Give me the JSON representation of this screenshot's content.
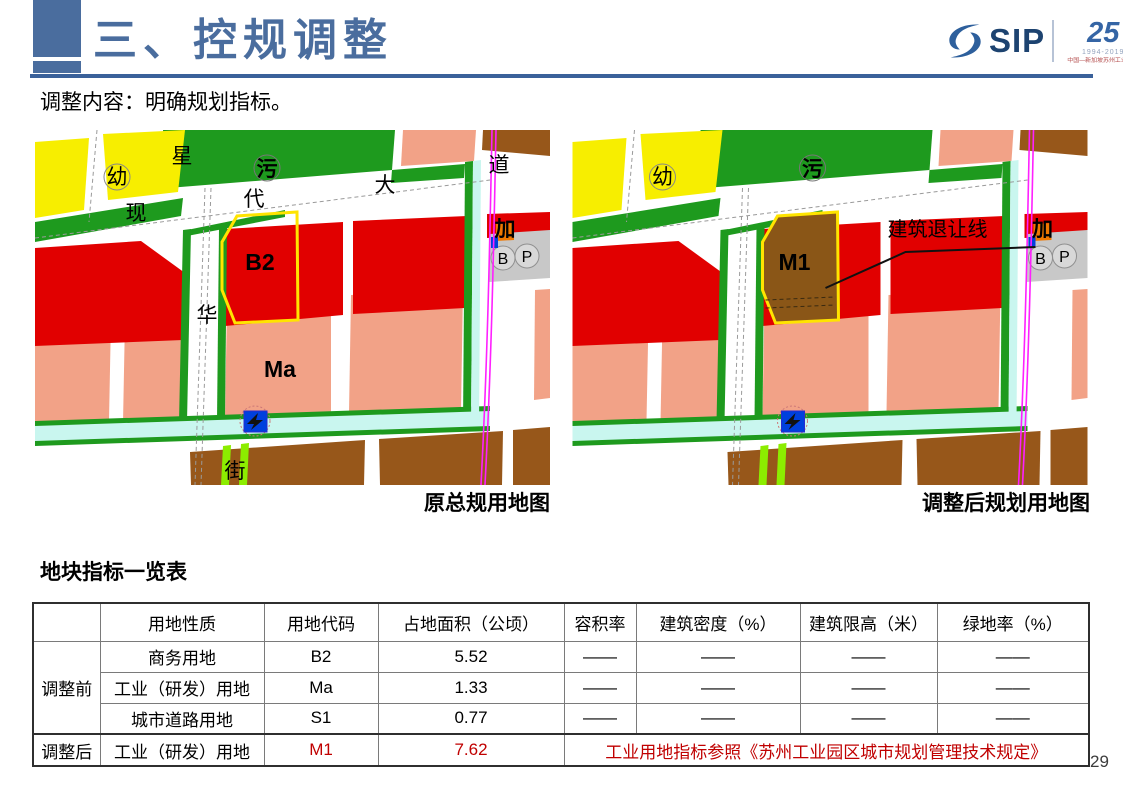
{
  "header": {
    "title": "三、控规调整",
    "logo": {
      "sip": "SIP",
      "anniversary": "25",
      "years": "1994-2019",
      "org": "中国—新加坡苏州工业园区"
    }
  },
  "intro": "调整内容：明确规划指标。",
  "maps": {
    "left": {
      "caption": "原总规用地图",
      "labels": {
        "kindergarten": "幼",
        "sewage": "污",
        "road_xing": "星",
        "road_hua": "华",
        "road_jie": "街",
        "road_xian": "现",
        "road_dai": "代",
        "road_da": "大",
        "road_dao": "道",
        "parcel": "B2",
        "parcel2": "Ma",
        "gas": "加",
        "bus": "B",
        "parking": "P"
      }
    },
    "right": {
      "caption": "调整后规划用地图",
      "labels": {
        "kindergarten": "幼",
        "sewage": "污",
        "parcel": "M1",
        "gas": "加",
        "bus": "B",
        "parking": "P",
        "setback": "建筑退让线"
      }
    }
  },
  "table": {
    "title": "地块指标一览表",
    "columns": [
      "",
      "用地性质",
      "用地代码",
      "占地面积（公顷）",
      "容积率",
      "建筑密度（%）",
      "建筑限高（米）",
      "绿地率（%）"
    ],
    "rows": [
      {
        "group": "调整前",
        "nature": "商务用地",
        "code": "B2",
        "area": "5.52",
        "far": "——",
        "density": "——",
        "height_limit": "——",
        "green_rate": "——"
      },
      {
        "nature": "工业（研发）用地",
        "code": "Ma",
        "area": "1.33",
        "far": "——",
        "density": "——",
        "height_limit": "——",
        "green_rate": "——"
      },
      {
        "nature": "城市道路用地",
        "code": "S1",
        "area": "0.77",
        "far": "——",
        "density": "——",
        "height_limit": "——",
        "green_rate": "——"
      },
      {
        "group": "调整后",
        "nature": "工业（研发）用地",
        "code": "M1",
        "area": "7.62",
        "note": "工业用地指标参照《苏州工业园区城市规划管理技术规定》"
      }
    ]
  },
  "page_number": "29",
  "palette": {
    "title_blue": "#4a6d9e",
    "accent_red": "#c00000",
    "land_green": "#1e9a1e",
    "land_yellow": "#f7ee00",
    "land_red": "#e10000",
    "land_pink": "#f2a287",
    "land_brown": "#97571a",
    "water_cyan": "#c9f6ef",
    "metro_magenta": "#ff20ff"
  }
}
